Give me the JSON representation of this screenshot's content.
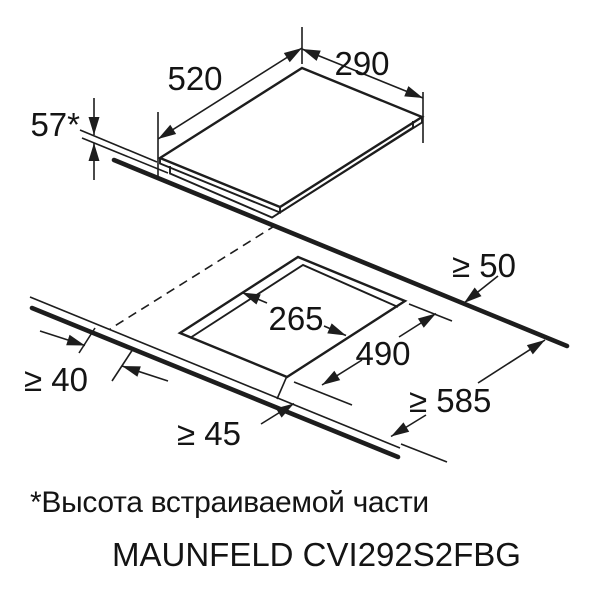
{
  "diagram": {
    "appliance": {
      "depth_label": "520",
      "width_label": "290",
      "built_in_height_label": "57*"
    },
    "cutout": {
      "width_label": "265",
      "depth_label": "490"
    },
    "clearances": {
      "rear_label": "≥ 50",
      "side_label": "≥ 40",
      "front_label": "≥ 45",
      "worktop_depth_label": "≥ 585"
    },
    "colors": {
      "line": "#1d1d1d",
      "background": "#ffffff"
    }
  },
  "footnote": {
    "text": "*Высота встраиваемой части"
  },
  "model": {
    "text": "MAUNFELD CVI292S2FBG"
  }
}
